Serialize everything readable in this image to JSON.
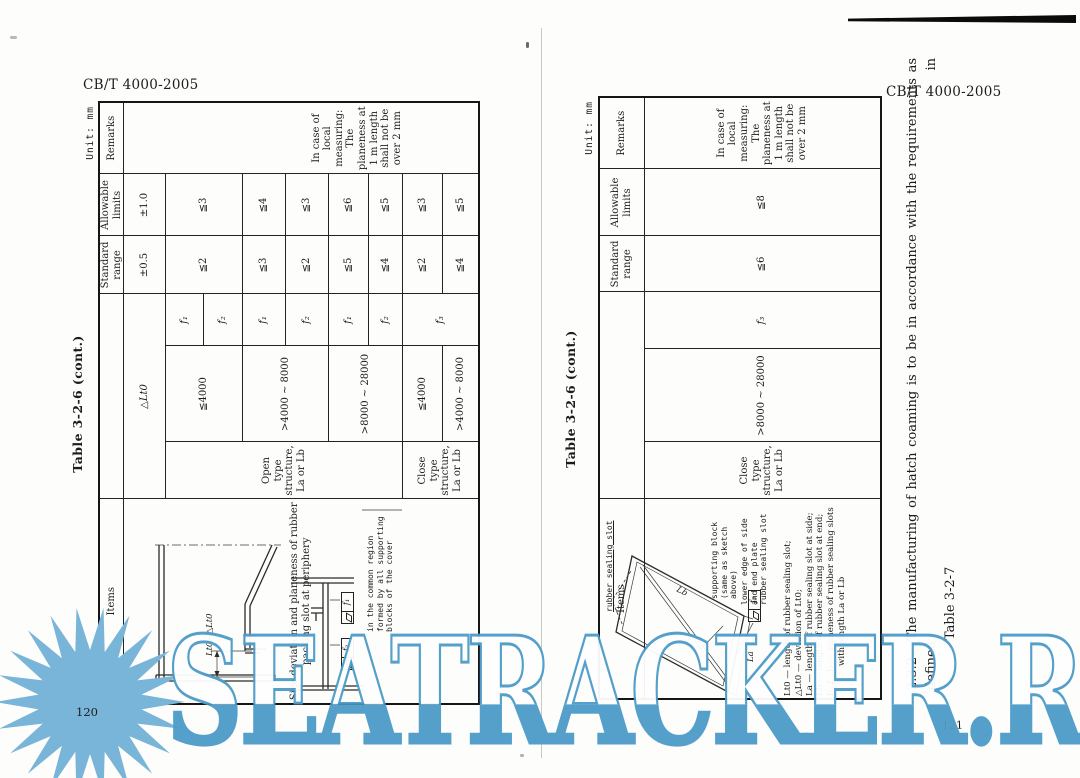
{
  "watermark": {
    "text": "SEATRACKER.RU"
  },
  "colors": {
    "watermark_blue": "#4d9cc9",
    "sun_blue": "#79b4d9",
    "ink": "#1c1c1c"
  },
  "page_left": {
    "doc_code": "CB/T 4000-2005",
    "page_number": "120",
    "table_title": "Table 3-2-6  (cont.)",
    "unit_label": "Unit: mm",
    "columns": {
      "items": "Items",
      "standard": "Standard range",
      "allowable": "Allowable limits",
      "remarks": "Remarks"
    },
    "item_description": "Size deviation and planeness of rubber packing slot at periphery",
    "remarks_text": "In case of local measuring: The planeness at 1 m length shall not be over 2 mm",
    "rows": {
      "delta": {
        "label": "△Lt0",
        "standard": "±0.5",
        "allowable": "±1.0"
      },
      "open_structure_label": "Open type structure, La or Lb",
      "close_structure_label": "Close type structure, La or Lb",
      "open": [
        {
          "range": "≦4000",
          "f_top": "f₁",
          "f_bottom": "f₂",
          "standard": "≦2",
          "allowable": "≦3"
        },
        {
          "range": ">4000 ~ 8000",
          "f_top": "f₁",
          "f_bottom": "f₂",
          "standard_top": "≦3",
          "allowable_top": "≦4",
          "standard_bottom": "≦2",
          "allowable_bottom": "≦3"
        },
        {
          "range": ">8000 ~ 28000",
          "f_top": "f₁",
          "f_bottom": "f₂",
          "standard_top": "≦5",
          "allowable_top": "≦6",
          "standard_bottom": "≦4",
          "allowable_bottom": "≦5"
        }
      ],
      "close": [
        {
          "range": "≦4000",
          "f": "f₃",
          "standard": "≦2",
          "allowable": "≦3"
        },
        {
          "range": ">4000 ~ 8000",
          "standard": "≦4",
          "allowable": "≦5"
        }
      ]
    },
    "diagram": {
      "dim_label": "Lt0+△Lt0",
      "note": "in the common region formed by all supporting blocks of the cover",
      "frame1": "f₁",
      "frame2": "f₂"
    }
  },
  "page_right": {
    "doc_code": "CB/T 4000-2005",
    "page_number": "121",
    "table_title": "Table 3-2-6  (cont.)",
    "unit_label": "Unit: mm",
    "columns": {
      "items": "Items",
      "standard": "Standard range",
      "allowable": "Allowable limits",
      "remarks": "Remarks"
    },
    "remarks_text": "In case of local measuring: The planeness at 1 m length shall not be over 2 mm",
    "row": {
      "structure": "Close type structure, La or Lb",
      "range": ">8000 ~ 28000",
      "f": "f₃",
      "standard": "≦6",
      "allowable": "≦8"
    },
    "legend": [
      "Lt0 — length of rubber sealing slot;",
      "△Lt0 — deviation of Lt0;",
      "La — length of rubber sealing slot at side;",
      "Lb — length of rubber sealing slot at end;",
      "f₁, f₂, f₃ — planeness of rubber sealing slots with length La or Lb"
    ],
    "diagram": {
      "slot_label": "rubber sealing slot",
      "block_label": "supporting block (same as sketch above)",
      "lower_label": "lower edge of side and end plate rubber sealing slot",
      "frame": "f₃",
      "dim_la": "La",
      "dim_lb": "Lb"
    },
    "paragraph": {
      "number": "2.3.2",
      "line1": "The manufacturing of hatch coaming is to be in accordance with the requirements as defined in",
      "line2": "Table 3-2-7"
    }
  }
}
